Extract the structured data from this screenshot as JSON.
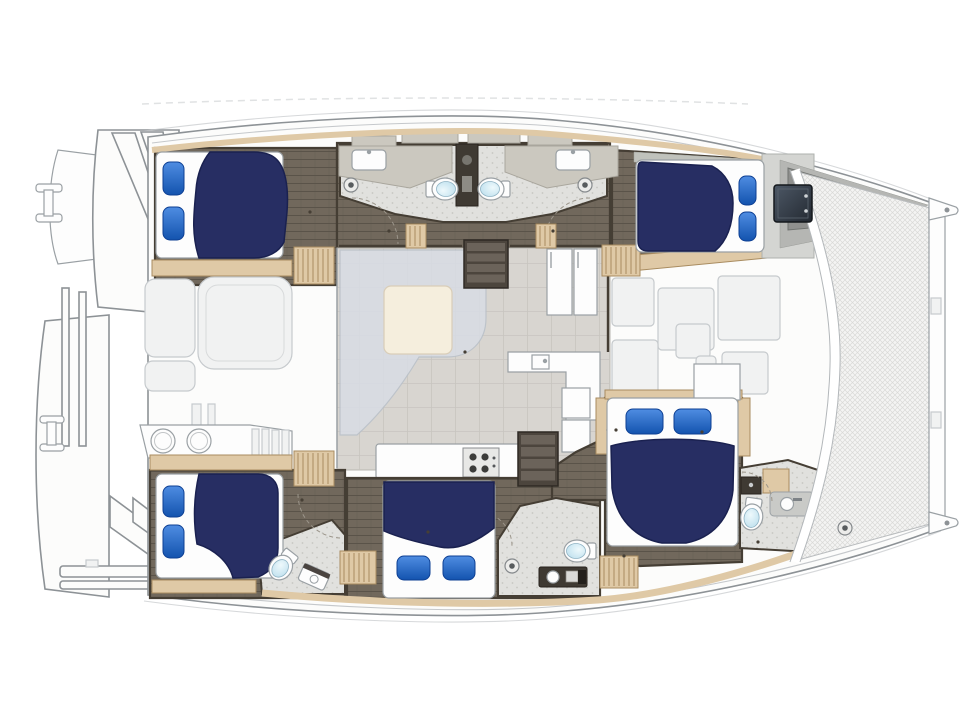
{
  "meta": {
    "kind": "catamaran-yacht-floorplan",
    "view": "top-down",
    "text_labels": []
  },
  "colors": {
    "hull_fill": "#fcfcfb",
    "hull_stroke": "#8d9296",
    "line_soft": "#c5c8cb",
    "ghost_fill": "#f1f2f2",
    "ghost_stroke": "#c6cacd",
    "white_fixture": "#fdfdfd",
    "fixture_stroke": "#9aa0a4",
    "wood_dark": "#71685c",
    "wood_dark_line": "#5a5349",
    "wood_light": "#dfc9a6",
    "wood_light_stroke": "#a98c60",
    "wall_dark": "#453e34",
    "bath_floor": "#e1e1de",
    "bath_speck": "#c7c7c2",
    "counter_beige": "#cbc8bf",
    "salon_floor": "#d8d5d0",
    "salon_grid": "#c7c4be",
    "sofa_ghost": "#d8dde5",
    "table_cream": "#f5eedd",
    "navy": "#272e63",
    "navy_stroke": "#1a2150",
    "pillow_blue_1": "#4f8de2",
    "pillow_blue_2": "#1353ae",
    "pillow_stroke": "#0d3f93",
    "toilet_lid_1": "#eef9fc",
    "toilet_lid_2": "#b5dbeb",
    "tv_dark_1": "#4d5866",
    "tv_dark_2": "#232931",
    "net_fill": "#f4f4f3",
    "net_line": "#d9d9d7",
    "locker_gray": "#8f908e",
    "locker_gray_light": "#b5b6b3",
    "steel": "#d9dbdc",
    "dark_unit": "#3f3a33"
  },
  "rooms": {
    "salon": "salon-galley",
    "cockpit": "aft-cockpit",
    "foredeck": "foredeck",
    "trampoline": "bow-trampoline-net",
    "cabins": [
      "port-aft-cabin",
      "port-fwd-cabin",
      "stbd-aft-cabin",
      "stbd-mid-cabin",
      "stbd-fwd-cabin"
    ],
    "heads": [
      "port-head-aft",
      "port-head-fwd",
      "stbd-aft-head",
      "stbd-mid-head",
      "stbd-fwd-head"
    ]
  },
  "furniture": {
    "beds": [
      {
        "id": "port-aft-berth",
        "mattress": [
          156,
          152,
          127,
          106
        ],
        "duvet": "M210,152 C201,163 197,176 196,190 C194,212 191,234 199,258 L254,258 C268,258 279,252 284,242 L287,212 C289,186 285,166 275,158 C269,153 261,152 253,152 Z",
        "pillows": [
          [
            163,
            162,
            21,
            33
          ],
          [
            163,
            207,
            21,
            33
          ]
        ]
      },
      {
        "id": "port-fwd-berth",
        "mattress": [
          636,
          160,
          128,
          92
        ],
        "duvet": "M642,162 L712,166 C726,173 733,187 733,203 C733,225 727,241 715,251 L648,251 C641,251 638,247 638,241 L638,169 C638,164 639,162 642,162 Z",
        "pillows": [
          [
            739,
            176,
            17,
            29
          ],
          [
            739,
            212,
            17,
            29
          ]
        ]
      },
      {
        "id": "stbd-aft-berth",
        "mattress": [
          156,
          474,
          127,
          104
        ],
        "duvet": "M199,474 L258,474 C271,474 278,482 278,493 L278,548 C278,562 271,572 258,577 L233,578 C229,562 214,549 197,544 C193,520 194,496 199,474 Z",
        "pillows": [
          [
            163,
            486,
            21,
            31
          ],
          [
            163,
            525,
            21,
            33
          ]
        ]
      },
      {
        "id": "stbd-mid-berth",
        "mattress": [
          383,
          481,
          112,
          117
        ],
        "duvet": "M384,482 L494,482 L494,528 C474,544 456,550 440,547 C420,543 400,538 384,531 Z",
        "pillows": [
          [
            397,
            556,
            33,
            24
          ],
          [
            443,
            556,
            32,
            24
          ]
        ]
      },
      {
        "id": "stbd-fwd-berth",
        "mattress": [
          607,
          398,
          131,
          148
        ],
        "duvet": "M611,446 C640,437 706,437 734,446 L733,490 C730,519 712,538 686,543 L662,543 C634,538 616,518 612,488 Z",
        "pillows": [
          [
            626,
            409,
            37,
            25
          ],
          [
            674,
            409,
            37,
            25
          ]
        ]
      }
    ],
    "toilets": [
      {
        "id": "port-head-aft",
        "cx": 443,
        "cy": 189,
        "rot": -90
      },
      {
        "id": "port-head-fwd",
        "cx": 493,
        "cy": 189,
        "rot": 90
      },
      {
        "id": "stbd-aft-head",
        "cx": 282,
        "cy": 566,
        "rot": 38
      },
      {
        "id": "stbd-mid-head",
        "cx": 579,
        "cy": 551,
        "rot": 90
      },
      {
        "id": "stbd-fwd-head",
        "cx": 752,
        "cy": 515,
        "rot": 8
      }
    ],
    "shower_drains": [
      [
        351,
        185
      ],
      [
        585,
        185
      ],
      [
        512,
        566
      ],
      [
        845,
        528
      ]
    ],
    "stairs_wood": [
      [
        294,
        247,
        40,
        37
      ],
      [
        602,
        245,
        38,
        31
      ],
      [
        294,
        451,
        40,
        35
      ],
      [
        340,
        551,
        36,
        33
      ],
      [
        600,
        556,
        38,
        32
      ],
      [
        406,
        224,
        20,
        24
      ],
      [
        536,
        224,
        20,
        24
      ]
    ],
    "stairs_dark": [
      [
        464,
        240,
        44,
        48
      ],
      [
        518,
        432,
        40,
        54
      ]
    ],
    "deck_hatches": [
      [
        612,
        278,
        42,
        48
      ],
      [
        658,
        288,
        56,
        62
      ],
      [
        718,
        276,
        62,
        64
      ],
      [
        676,
        324,
        34,
        34
      ],
      [
        696,
        356,
        20,
        22
      ],
      [
        612,
        340,
        46,
        80
      ],
      [
        722,
        352,
        46,
        42
      ]
    ],
    "floor_dots": [
      [
        389,
        231
      ],
      [
        553,
        231
      ],
      [
        310,
        212
      ],
      [
        302,
        500
      ],
      [
        428,
        532
      ],
      [
        616,
        430
      ],
      [
        702,
        432
      ],
      [
        624,
        556
      ],
      [
        465,
        352
      ],
      [
        758,
        542
      ]
    ]
  }
}
